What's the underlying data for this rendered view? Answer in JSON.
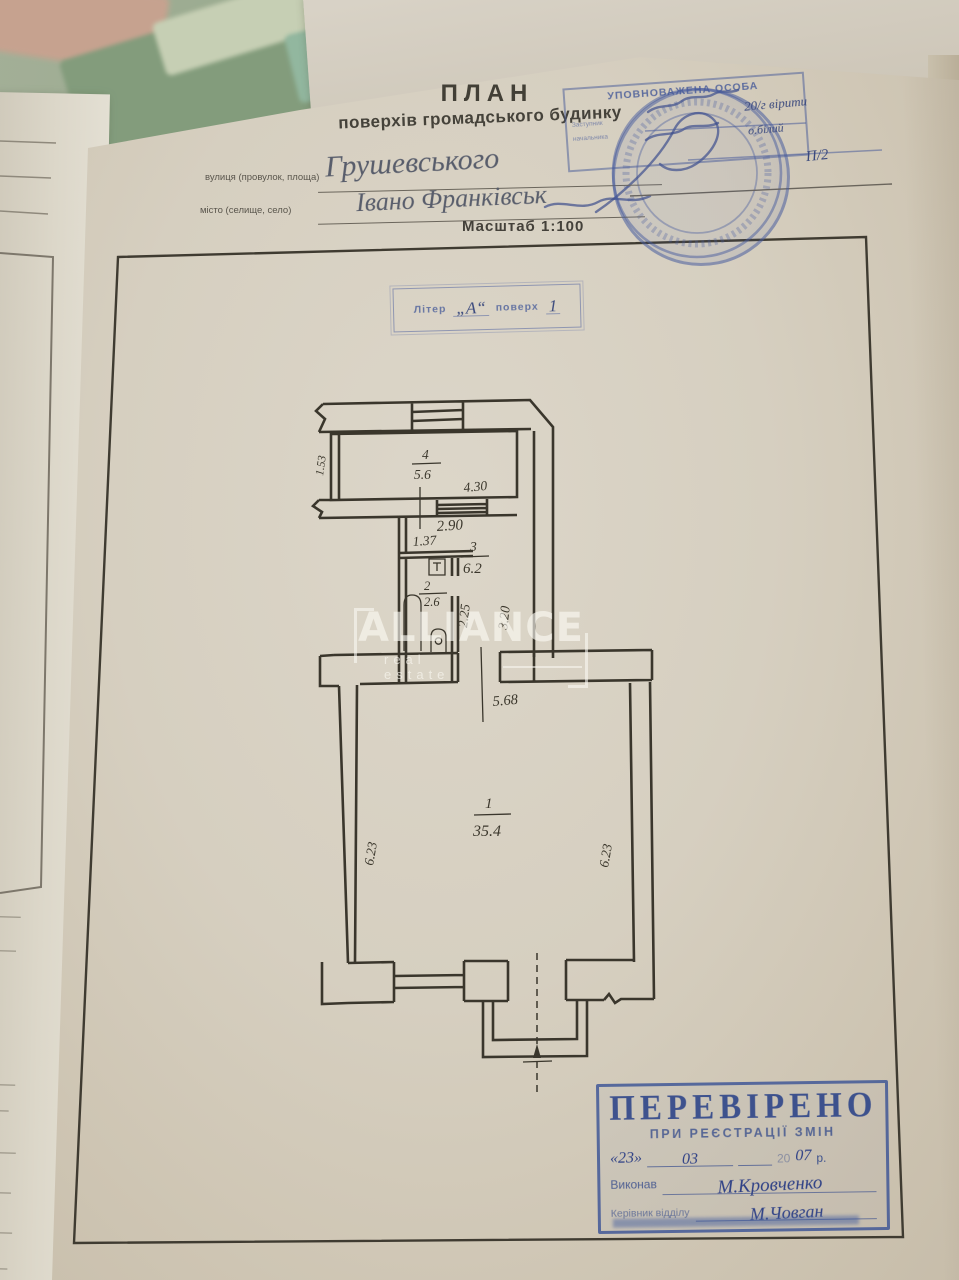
{
  "header": {
    "title": "ПЛАН",
    "subtitle": "поверхів громадського будинку",
    "street_label": "вулиця (провулок, площа)",
    "street_value": "Грушевського",
    "city_label": "місто (селище, село)",
    "city_value": "Івано  Франківськ",
    "scale": "Масштаб 1:100"
  },
  "authority_stamp": {
    "heading": "УПОВНОВАЖЕНА ОСОБА",
    "assistant_line1": "Заступник",
    "assistant_line2": "начальника",
    "note1": "20/г  вірити",
    "note2": "о.білий",
    "note3": "П/2"
  },
  "liter_stamp": {
    "label": "Літер",
    "value": "„А“",
    "floor_label": "поверх",
    "floor_value": "1"
  },
  "plan": {
    "rooms": [
      {
        "num": "1",
        "area": "35.4"
      },
      {
        "num": "2",
        "area": "2.6"
      },
      {
        "num": "3",
        "area": "6.2"
      },
      {
        "num": "4",
        "area": "5.6"
      }
    ],
    "dims": {
      "d153": "1.53",
      "d430": "4.30",
      "d290": "2.90",
      "d137": "1.37",
      "d225": "2.25",
      "d320": "3.20",
      "d568": "5.68",
      "d623l": "6.23",
      "d623r": "6.23"
    }
  },
  "watermark": {
    "brand": "ALLIANCE",
    "tagline": "real estate"
  },
  "verified_stamp": {
    "title": "ПЕРЕВІРЕНО",
    "subtitle": "ПРИ РЕЄСТРАЦІЇ ЗМІН",
    "day": "«23»",
    "month": "03",
    "year_prefix": "20",
    "year": "07",
    "year_suffix": "р.",
    "executor_label": "Виконав",
    "executor_name": "М.Кровченко",
    "head_label": "Керівник відділу",
    "head_name": "М.Човган"
  },
  "under_page": {
    "fragments": [
      "ним",
      "им)",
      "тям"
    ]
  }
}
